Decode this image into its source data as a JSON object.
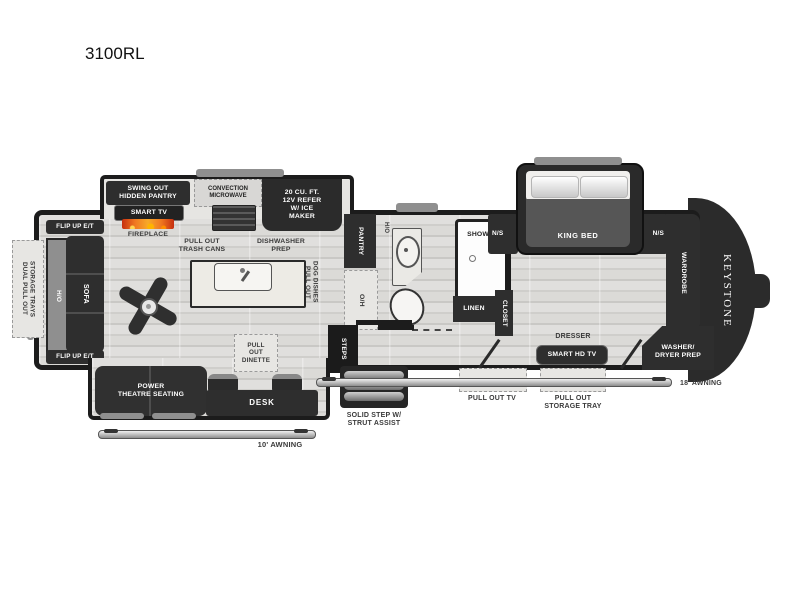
{
  "title": "3100RL",
  "brand": "KEYSTONE",
  "colors": {
    "wall": "#1c1c1c",
    "dark_furniture": "#2e2e2e",
    "floor_light": "#dedddb",
    "counter": "#edebe5",
    "trim_gray": "#8f8f8f",
    "label_text": "#3a3a3a",
    "flame_orange": "#f07820"
  },
  "exterior": {
    "storage_trays": "DUAL PULL OUT\nSTORAGE TRAYS",
    "awning_small": "10' AWNING",
    "awning_large": "18' AWNING",
    "entry_step": "SOLID STEP W/\nSTRUT ASSIST",
    "pull_out_tv": "PULL OUT TV",
    "pull_out_storage_tray": "PULL OUT\nSTORAGE TRAY"
  },
  "living": {
    "flip_up_et": "FLIP UP E/T",
    "ho": "H/O",
    "sofa": "SOFA",
    "theatre": "POWER\nTHEATRE SEATING",
    "desk": "DESK",
    "dinette": "PULL\nOUT\nDINETTE",
    "smart_tv": "SMART TV",
    "fireplace": "FIREPLACE"
  },
  "kitchen": {
    "hidden_pantry": "SWING OUT\nHIDDEN PANTRY",
    "microwave": "CONVECTION\nMICROWAVE",
    "refrigerator": "20 CU. FT.\n12V REFER\nW/ ICE\nMAKER",
    "trash": "PULL OUT\nTRASH CANS",
    "dishwasher": "DISHWASHER\nPREP",
    "dog_dishes": "PULL OUT\nDOG DISHES",
    "pantry": "PANTRY",
    "overhead": "O/H"
  },
  "bath": {
    "ho": "H/O",
    "shower": "SHOWER",
    "linen": "LINEN",
    "closet": "CLOSET",
    "steps": "STEPS"
  },
  "bedroom": {
    "king_bed": "KING BED",
    "ns_left": "N/S",
    "ns_right": "N/S",
    "wardrobe": "WARDROBE",
    "dresser": "DRESSER",
    "smart_hd_tv": "SMART HD TV",
    "washer_dryer": "WASHER/\nDRYER PREP"
  }
}
